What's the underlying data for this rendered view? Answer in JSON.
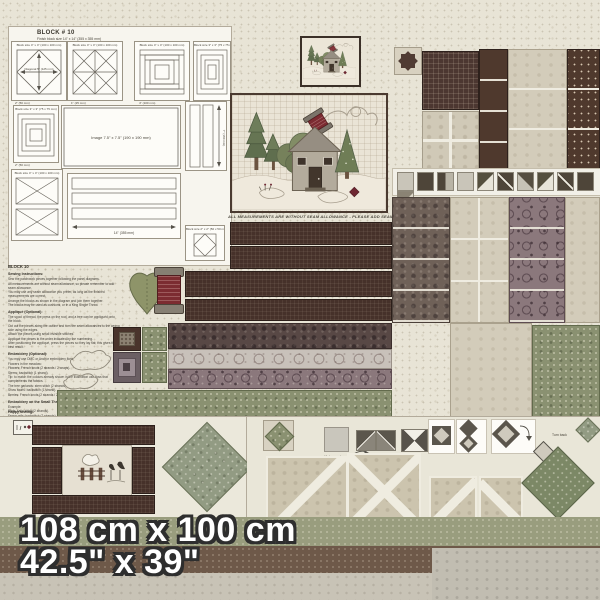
{
  "panel": {
    "title": "BLOCK # 10",
    "subtitle": "Finish block size 14\" x 14\"  (355 x 355 mm)",
    "note": "ALL MEASUREMENTS ARE WITHOUT SEAM ALLOWANCE - PLEASE ADD SEAM ALLOWANCE",
    "size_metric": "108 cm x 100 cm",
    "size_imperial": "42.5\" x 39\""
  },
  "diagrams": {
    "d1": {
      "header": "Block size 4\" x 4\"  (100 x 100 mm)",
      "inner": "Diagonal 5\" (125 mm)"
    },
    "d2": {
      "header": "Block size 4\" x 4\"  (100 x 100 mm)"
    },
    "d3": {
      "header": "Block size 4\" x 4\"  (100 x 100 mm)"
    },
    "d9": {
      "header": "Block size 3\" x 3\"  (75 x 75 mm)"
    },
    "d10": {
      "header": "Block size 3\" x 3\"  (75 x 75 mm)"
    },
    "d5": {
      "header": "Image  7.5\" x 7.5\"  (190 x 190 mm)"
    },
    "d4": {
      "label": "7\" (180 mm)"
    },
    "d6": {
      "header": "Block size 4\" x 4\"  (100 x 100 mm)"
    },
    "d7": {
      "label": "14\" (355 mm)"
    },
    "d8": {
      "header": "Block size 2\" x 2\"  (50 x 50 mm)"
    }
  },
  "dims": [
    "2\" (50 mm)",
    "1\" (25 mm)",
    "4\" (100 mm)",
    "2\" (50 mm)"
  ],
  "instructions": {
    "title": "BLOCK 10",
    "sections": [
      {
        "heading": "Sewing Instructions:",
        "lines": [
          "Sew the patchwork pieces together following the panel diagrams.",
          "All measurements are without seam allowance, so please remember to add seam allowance.",
          "You may use any seam allowance you prefer, as long as the finished measurements are correct.",
          "Arrange the blocks as shown in the diagram and join them together.",
          "The blocks may be used as cushions, or in a King Single Throw."
        ]
      },
      {
        "heading": "Appliqué (Optional):",
        "lines": [
          "The spool of thread, the press on the roof, and a tree can be appliquéd onto the block.",
          "Cut out the pieces along the outline and turn the seam allowances to the wrong side using the edges.",
          "Attach the pieces using small invisible stitches.",
          "Appliqué the pieces in the order indicated by the numbering.",
          "After positioning the appliqué, press the pieces so they lay flat; this gives the best result."
        ]
      },
      {
        "heading": "Embroidery (Optional):",
        "lines": [
          "You may use DMC or Anchor embroidery floss.",
          "Flowers in the meadow:",
          "Flowers: French knots (2 strands / 2 wraps).",
          "Stems: backstitch (1 strand).",
          "Tip: to match the colours already shown in the illustration use floss that complements the fabrics.",
          "The tree garlands: stem stitch (2 strands).",
          "Snow swirls: backstitch (1 strand).",
          "Berries: French knots (2 strands / 2 wraps)."
        ]
      },
      {
        "heading": "Embroidery on the Small Throw:",
        "lines": [
          "Example:",
          "Birds: satin stitch (2 strands).",
          "Fence rails: backstitch (2 strands).",
          "Grass tufts: straight stitch (1 strand).",
          "Seed dots: French knots (2 strands / 2 wraps).",
          "Snow mounds: running stitch (1 strand).",
          "You may optionally add some blades of grass to the snow, using long and short stitches.",
          "A simple row of quilting in the ditch will finish the panel nicely."
        ]
      }
    ],
    "closing": "Happy sewing!"
  },
  "annotations": {
    "make_note": "Make sparks",
    "turn_note": "Turn back"
  },
  "hst_row": {
    "patterns": [
      "light",
      "dark",
      "split",
      "light",
      "diag-a",
      "slash",
      "diag-b",
      "diag-a",
      "slash",
      "dark",
      "diag-c"
    ]
  }
}
